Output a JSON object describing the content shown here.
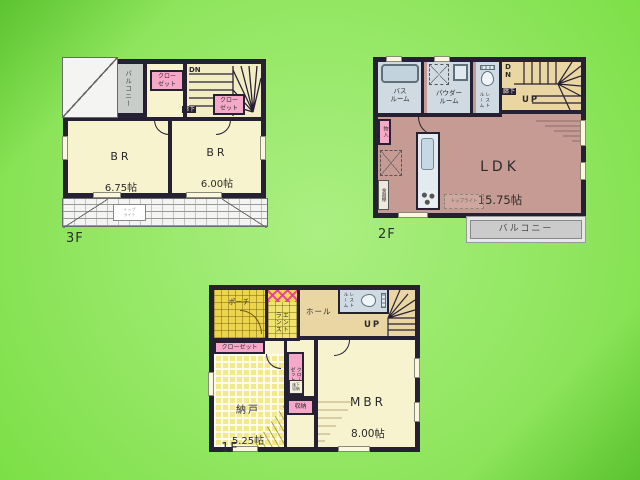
{
  "colors": {
    "background_green": "#8fe55e",
    "wall": "#262033",
    "room_cream": "#f8f3cf",
    "ldk_mauve": "#c69b93",
    "stair_tan": "#e9d6a3",
    "closet_pink": "#f5a8c8",
    "bath_blue": "#cfdae2",
    "balcony_gray": "#c9cdc9",
    "porch_yellow": "#ecd44c",
    "nando_yellow": "#f3e98a"
  },
  "floor3": {
    "label": "3F",
    "balcony": "バルコニー",
    "closet_top": "クロー\nゼット",
    "closet_mid": "クロー\nゼット",
    "dn": "DN",
    "hallway": "廊下",
    "br1_name": "BR",
    "br1_size": "6.75帖",
    "br2_name": "BR",
    "br2_size": "6.00帖",
    "skylight": "トップ\nライト"
  },
  "floor2": {
    "label": "2F",
    "bath": "バス\nルーム",
    "powder": "パウダー\nルーム",
    "restroom": "レスト\nルーム",
    "dn": "D\nN",
    "hallway": "廊下",
    "up": "UP",
    "ldk_name": "LDK",
    "ldk_size": "15.75帖",
    "storage": "物入",
    "cupboard": "食器棚",
    "skylight": "トップライト",
    "balcony": "バルコニー"
  },
  "floor1": {
    "label": "1F",
    "porch": "ポーチ",
    "entrance": "エント\nランス",
    "hall": "ホール",
    "restroom": "レスト\nルーム",
    "up": "UP",
    "closet_top": "クローゼット",
    "nando_name": "納戸",
    "nando_size": "5.25帖",
    "closet_mid": "クロー\nゼット",
    "underfloor": "床下\n収納",
    "storage": "収納",
    "mbr_name": "MBR",
    "mbr_size": "8.00帖"
  }
}
